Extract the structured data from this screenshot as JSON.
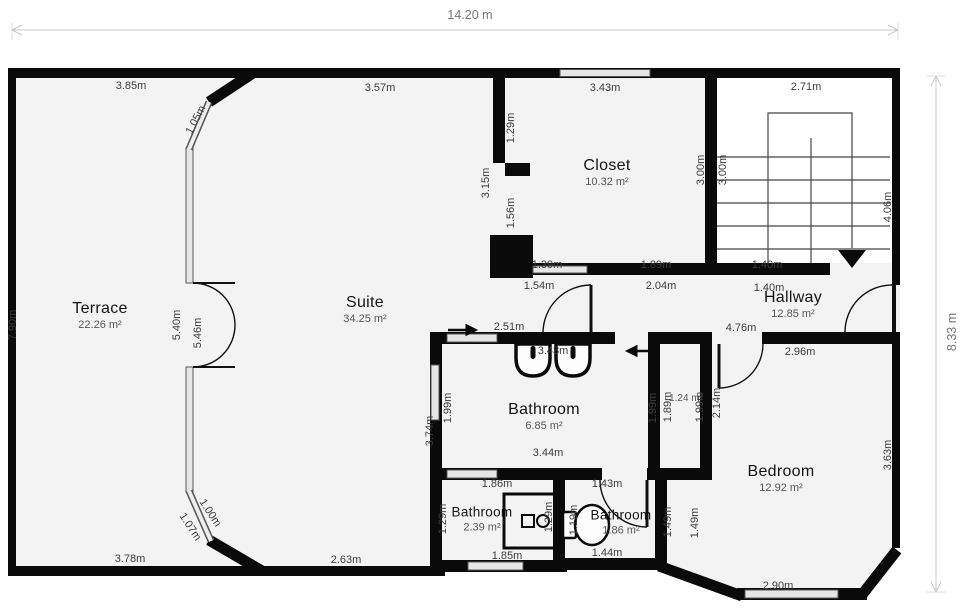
{
  "plan": {
    "overall_width": "14.20 m",
    "overall_height": "8.33 m"
  },
  "rooms": [
    {
      "name": "Terrace",
      "area": "22.26 m²"
    },
    {
      "name": "Suite",
      "area": "34.25 m²"
    },
    {
      "name": "Closet",
      "area": "10.32 m²"
    },
    {
      "name": "Hallway",
      "area": "12.85 m²"
    },
    {
      "name": "Bathroom",
      "area": "6.85 m²"
    },
    {
      "name": "Bathroom",
      "area": "2.39 m²"
    },
    {
      "name": "Bathroom",
      "area": "1.86 m²"
    },
    {
      "name": "Bedroom",
      "area": "12.92 m²"
    },
    {
      "name": "",
      "area": "1.24 m²"
    }
  ],
  "dimension_labels": [
    "3.85m",
    "3.57m",
    "3.43m",
    "2.71m",
    "1.05m",
    "7.90m",
    "1.29m",
    "3.15m",
    "1.56m",
    "3.00m",
    "3.00m",
    "4.06m",
    "1.39m",
    "1.89m",
    "1.40m",
    "1.54m",
    "2.04m",
    "1.40m",
    "5.40m",
    "5.46m",
    "2.51m",
    "4.76m",
    "2.96m",
    "3.43m",
    "1.99m",
    "1.99m",
    "3.74m",
    "1.89m",
    "1.99m",
    "2.14m",
    "3.44m",
    "1.86m",
    "1.43m",
    "3.63m",
    "1.29m",
    "1.29m",
    "1.19m",
    "1.49m",
    "1.49m",
    "1.07m",
    "1.00m",
    "3.78m",
    "2.63m",
    "1.85m",
    "1.44m",
    "2.90m"
  ]
}
